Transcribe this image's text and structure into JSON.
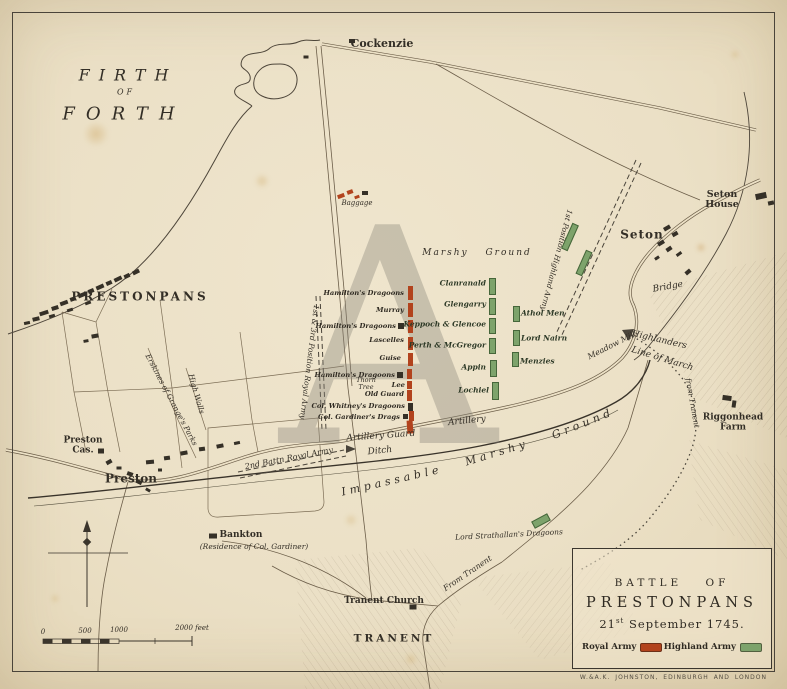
{
  "map": {
    "watermark": "A",
    "credit": "W.&A.K. JOHNSTON, EDINBURGH AND LONDON",
    "colors": {
      "paper": "#ece1c6",
      "ink": "#353027",
      "royal_red": "#b2431d",
      "highland_green": "#7da36b"
    },
    "title_box": {
      "line1": "BATTLE OF",
      "line2": "PRESTONPANS",
      "date_day": "21",
      "date_suffix": "st",
      "date_rest": " September 1745.",
      "legend": [
        {
          "label": "Royal Army",
          "color": "#b2431d"
        },
        {
          "label": "Highland Army",
          "color": "#7da36b"
        }
      ]
    },
    "labels": [
      {
        "id": "firth",
        "text": "FIRTH",
        "x": 128,
        "y": 75,
        "size": 16,
        "italic": true,
        "sp": 9
      },
      {
        "id": "firth-of",
        "text": "OF",
        "x": 126,
        "y": 93,
        "size": 8,
        "italic": true,
        "sp": 3
      },
      {
        "id": "forth",
        "text": "FORTH",
        "x": 124,
        "y": 114,
        "size": 18,
        "italic": true,
        "sp": 11
      },
      {
        "id": "cockenzie",
        "text": "Cockenzie",
        "x": 382,
        "y": 44,
        "size": 11,
        "bold": true
      },
      {
        "id": "seton-house",
        "text": "Seton House",
        "x": 722,
        "y": 200,
        "size": 9.5,
        "bold": true
      },
      {
        "id": "seton",
        "text": "Seton",
        "x": 642,
        "y": 235,
        "size": 12,
        "bold": true,
        "sp": 1
      },
      {
        "id": "bridge",
        "text": "Bridge",
        "x": 668,
        "y": 288,
        "size": 9,
        "italic": true,
        "rot": -10
      },
      {
        "id": "prestonpans",
        "text": "PRESTONPANS",
        "x": 140,
        "y": 297,
        "size": 12,
        "bold": true,
        "sp": 3
      },
      {
        "id": "baggage",
        "text": "Baggage",
        "x": 357,
        "y": 204,
        "size": 7,
        "italic": true
      },
      {
        "id": "marshy-ground-ne",
        "text": "Marshy  Ground",
        "x": 477,
        "y": 254,
        "size": 9,
        "italic": true,
        "sp": 2,
        "ws": 12
      },
      {
        "id": "first-pos-highland",
        "text": "1st Position Highland Army",
        "x": 556,
        "y": 260,
        "size": 7.5,
        "italic": true,
        "rot": 105
      },
      {
        "id": "first-third-pos-royal",
        "text": "1st & 3rd Position Royal Army",
        "x": 309,
        "y": 362,
        "size": 7.5,
        "italic": true,
        "rot": 97
      },
      {
        "id": "second-battn-royal",
        "text": "2nd Battn Royal Army",
        "x": 289,
        "y": 459,
        "size": 8,
        "italic": true,
        "rot": -11
      },
      {
        "id": "artillery-guard",
        "text": "Artillery Guard",
        "x": 381,
        "y": 437,
        "size": 9,
        "italic": true,
        "rot": -4
      },
      {
        "id": "artillery",
        "text": "Artillery",
        "x": 467,
        "y": 422,
        "size": 9,
        "italic": true,
        "rot": -6
      },
      {
        "id": "ditch",
        "text": "Ditch",
        "x": 380,
        "y": 452,
        "size": 9,
        "italic": true,
        "rot": -6
      },
      {
        "id": "impassable",
        "text": "Impassable",
        "x": 392,
        "y": 481,
        "size": 11,
        "italic": true,
        "rot": -13,
        "sp": 4
      },
      {
        "id": "marshy",
        "text": "Marshy",
        "x": 497,
        "y": 453,
        "size": 11,
        "italic": true,
        "rot": -17,
        "sp": 4
      },
      {
        "id": "ground",
        "text": "Ground",
        "x": 583,
        "y": 424,
        "size": 11,
        "italic": true,
        "rot": -22,
        "sp": 4
      },
      {
        "id": "erskines",
        "text": "Erskines of Grange's Parks",
        "x": 171,
        "y": 400,
        "size": 7.5,
        "italic": true,
        "rot": 62
      },
      {
        "id": "high-walls",
        "text": "High Walls",
        "x": 196,
        "y": 394,
        "size": 7.5,
        "italic": true,
        "rot": 74
      },
      {
        "id": "meadow-mill",
        "text": "Meadow Mill",
        "x": 612,
        "y": 346,
        "size": 8,
        "italic": true,
        "rot": -27
      },
      {
        "id": "highlanders",
        "text": "Highlanders",
        "x": 659,
        "y": 341,
        "size": 9,
        "italic": true,
        "rot": 13
      },
      {
        "id": "line-of-march",
        "text": "Line of March",
        "x": 662,
        "y": 360,
        "size": 9,
        "italic": true,
        "rot": 17
      },
      {
        "id": "from-tranent-east",
        "text": "from Tranent",
        "x": 692,
        "y": 403,
        "size": 7.5,
        "italic": true,
        "rot": 80
      },
      {
        "id": "riggonhead-farm",
        "text": "Riggonhead\nFarm",
        "x": 733,
        "y": 423,
        "size": 9,
        "bold": true
      },
      {
        "id": "preston-cas",
        "text": "Preston\nCas.",
        "x": 83,
        "y": 446,
        "size": 9,
        "bold": true
      },
      {
        "id": "preston",
        "text": "Preston",
        "x": 131,
        "y": 479,
        "size": 12,
        "bold": true
      },
      {
        "id": "bankton",
        "text": "Bankton",
        "x": 241,
        "y": 536,
        "size": 9,
        "bold": true
      },
      {
        "id": "bankton-residence",
        "text": "(Residence of Col. Gardiner)",
        "x": 254,
        "y": 547,
        "size": 7.5,
        "italic": true
      },
      {
        "id": "lord-strathallan",
        "text": "Lord Strathallan's Dragoons",
        "x": 509,
        "y": 535,
        "size": 7.5,
        "italic": true,
        "rot": -3
      },
      {
        "id": "from-tranent-west",
        "text": "From Tranent",
        "x": 468,
        "y": 574,
        "size": 8,
        "italic": true,
        "rot": -34
      },
      {
        "id": "tranent-church",
        "text": "Tranent Church",
        "x": 384,
        "y": 602,
        "size": 9,
        "bold": true
      },
      {
        "id": "tranent",
        "text": "TRANENT",
        "x": 394,
        "y": 639,
        "size": 10.5,
        "bold": true,
        "sp": 3
      },
      {
        "id": "thorn-tree",
        "text": "Thorn\nTree",
        "x": 366,
        "y": 384,
        "size": 6.5,
        "italic": true
      },
      {
        "id": "scale-0",
        "text": "0",
        "x": 43,
        "y": 633,
        "size": 7,
        "italic": true
      },
      {
        "id": "scale-500",
        "text": "500",
        "x": 85,
        "y": 632,
        "size": 7,
        "italic": true
      },
      {
        "id": "scale-1000",
        "text": "1000",
        "x": 119,
        "y": 631,
        "size": 7,
        "italic": true
      },
      {
        "id": "scale-2000",
        "text": "2000 feet",
        "x": 192,
        "y": 629,
        "size": 7,
        "italic": true
      }
    ],
    "royal_units": [
      {
        "name": "Hamilton's Dragoons",
        "x": 404,
        "y": 293,
        "bars": [
          [
            408,
            286,
            14,
            "red"
          ]
        ]
      },
      {
        "name": "Murray",
        "x": 404,
        "y": 310,
        "bars": [
          [
            408,
            303,
            14,
            "red"
          ]
        ]
      },
      {
        "name": "Hamilton's Dragoons",
        "x": 396,
        "y": 326,
        "bars": [
          [
            408,
            320,
            13,
            "red"
          ],
          [
            398,
            323,
            6,
            "dark",
            6
          ]
        ]
      },
      {
        "name": "Lascelles",
        "x": 404,
        "y": 340,
        "bars": [
          [
            408,
            337,
            13,
            "red"
          ]
        ]
      },
      {
        "name": "Guise",
        "x": 401,
        "y": 358,
        "bars": [
          [
            408,
            353,
            13,
            "red"
          ]
        ]
      },
      {
        "name": "Hamilton's Dragoons",
        "x": 395,
        "y": 375,
        "bars": [
          [
            407,
            369,
            10,
            "red"
          ],
          [
            397,
            372,
            6,
            "dark",
            6
          ]
        ]
      },
      {
        "name": "Lee",
        "x": 405,
        "y": 385,
        "bars": [
          [
            407,
            381,
            8,
            "red"
          ]
        ]
      },
      {
        "name": "Old Guard",
        "x": 404,
        "y": 394,
        "bars": [
          [
            407,
            390,
            11,
            "red"
          ]
        ]
      },
      {
        "name": "Col. Whitney's Dragoons",
        "x": 405,
        "y": 406,
        "bars": [
          [
            408,
            403,
            8,
            "dark"
          ]
        ]
      },
      {
        "name": "Col. Gardiner's Drags",
        "x": 400,
        "y": 417,
        "bars": [
          [
            409,
            411,
            10,
            "red"
          ],
          [
            403,
            414,
            5,
            "dark",
            5
          ]
        ]
      }
    ],
    "highland_units": [
      {
        "name": "Clanranald",
        "lx": 486,
        "ly": 283,
        "side": "left",
        "bar": [
          489,
          278,
          15
        ]
      },
      {
        "name": "Glengarry",
        "lx": 486,
        "ly": 304,
        "side": "left",
        "bar": [
          489,
          298,
          15
        ]
      },
      {
        "name": "Keppoch & Glencoe",
        "lx": 486,
        "ly": 324,
        "side": "left",
        "bar": [
          489,
          318,
          14
        ]
      },
      {
        "name": "Perth & McGregor",
        "lx": 486,
        "ly": 345,
        "side": "left",
        "bar": [
          489,
          338,
          14
        ]
      },
      {
        "name": "Appin",
        "lx": 486,
        "ly": 367,
        "side": "left",
        "bar": [
          490,
          360,
          15
        ]
      },
      {
        "name": "Lochiel",
        "lx": 489,
        "ly": 390,
        "side": "left",
        "bar": [
          492,
          382,
          16
        ]
      },
      {
        "name": "Athol Men",
        "lx": 521,
        "ly": 313,
        "side": "right",
        "bar": [
          513,
          306,
          14
        ]
      },
      {
        "name": "Lord Nairn",
        "lx": 521,
        "ly": 338,
        "side": "right",
        "bar": [
          513,
          330,
          14
        ]
      },
      {
        "name": "Menzies",
        "lx": 520,
        "ly": 361,
        "side": "right",
        "bar": [
          512,
          352,
          13
        ]
      }
    ],
    "marks": [
      [
        44,
        313,
        9,
        4,
        -18
      ],
      [
        55,
        308,
        7,
        4,
        -18
      ],
      [
        64,
        303,
        8,
        4,
        -20
      ],
      [
        73,
        299,
        6,
        4,
        -20
      ],
      [
        82,
        295,
        8,
        4,
        -22
      ],
      [
        91,
        291,
        6,
        4,
        -22
      ],
      [
        100,
        287,
        8,
        4,
        -24
      ],
      [
        109,
        283,
        6,
        4,
        -24
      ],
      [
        118,
        279,
        8,
        4,
        -26
      ],
      [
        127,
        276,
        6,
        4,
        -26
      ],
      [
        136,
        272,
        7,
        4,
        -26
      ],
      [
        88,
        303,
        6,
        3,
        -20
      ],
      [
        70,
        310,
        6,
        3,
        -18
      ],
      [
        52,
        316,
        6,
        3,
        -16
      ],
      [
        36,
        319,
        7,
        4,
        -14
      ],
      [
        27,
        323,
        6,
        3,
        -12
      ],
      [
        95,
        336,
        7,
        4,
        -10
      ],
      [
        86,
        341,
        5,
        3,
        -10
      ],
      [
        150,
        462,
        8,
        4,
        -5
      ],
      [
        167,
        458,
        6,
        4,
        -8
      ],
      [
        184,
        453,
        7,
        4,
        -10
      ],
      [
        202,
        449,
        6,
        4,
        -8
      ],
      [
        220,
        446,
        7,
        4,
        -12
      ],
      [
        237,
        443,
        6,
        3,
        -12
      ],
      [
        130,
        474,
        6,
        4,
        20
      ],
      [
        139,
        482,
        6,
        4,
        25
      ],
      [
        148,
        490,
        5,
        3,
        30
      ],
      [
        119,
        468,
        5,
        3,
        0
      ],
      [
        109,
        462,
        6,
        4,
        -30
      ],
      [
        160,
        470,
        4,
        3,
        0
      ],
      [
        101,
        451,
        6,
        5,
        0
      ],
      [
        667,
        228,
        7,
        4,
        -30
      ],
      [
        675,
        234,
        6,
        4,
        -30
      ],
      [
        661,
        243,
        7,
        4,
        -32
      ],
      [
        669,
        249,
        6,
        4,
        -34
      ],
      [
        679,
        254,
        6,
        3,
        -36
      ],
      [
        657,
        258,
        5,
        3,
        -34
      ],
      [
        688,
        272,
        6,
        4,
        -40
      ],
      [
        761,
        196,
        11,
        6,
        -12
      ],
      [
        771,
        203,
        6,
        4,
        -12
      ],
      [
        727,
        398,
        9,
        5,
        8
      ],
      [
        734,
        404,
        4,
        7,
        8
      ],
      [
        213,
        536,
        8,
        5,
        0
      ],
      [
        413,
        607,
        7,
        5,
        0
      ],
      [
        352,
        41,
        6,
        4,
        0
      ],
      [
        306,
        57,
        5,
        3,
        0
      ],
      [
        341,
        196,
        7,
        4,
        -20,
        "red"
      ],
      [
        350,
        192,
        6,
        4,
        -20,
        "red"
      ],
      [
        357,
        197,
        5,
        3,
        -20,
        "red"
      ],
      [
        365,
        193,
        6,
        4,
        0
      ],
      [
        410,
        427,
        6,
        13,
        -4,
        "red"
      ],
      [
        570,
        237,
        5,
        26,
        24,
        "green"
      ],
      [
        584,
        263,
        5,
        24,
        24,
        "green"
      ],
      [
        541,
        521,
        16,
        6,
        -28,
        "green"
      ]
    ]
  }
}
